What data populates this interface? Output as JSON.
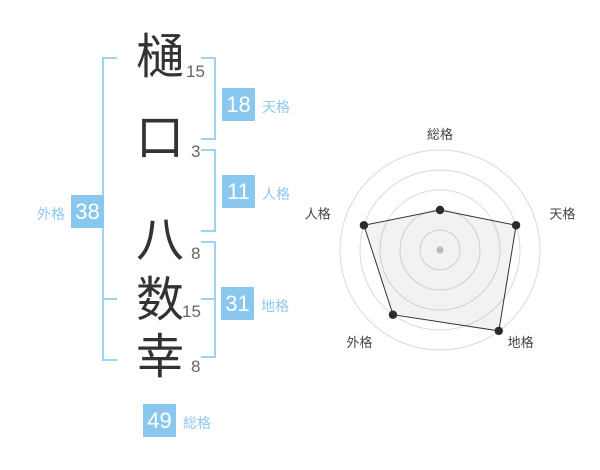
{
  "name_panel": {
    "chars": [
      {
        "char": "樋",
        "strokes": "15"
      },
      {
        "char": "口",
        "strokes": "3"
      },
      {
        "char": "八",
        "strokes": "8"
      },
      {
        "char": "数",
        "strokes": "15"
      },
      {
        "char": "幸",
        "strokes": "8"
      }
    ]
  },
  "kaku": {
    "tenkaku": {
      "label": "天格",
      "value": "18"
    },
    "jinkaku": {
      "label": "人格",
      "value": "11"
    },
    "chikaku": {
      "label": "地格",
      "value": "31"
    },
    "gaikaku": {
      "label": "外格",
      "value": "38"
    },
    "soukaku": {
      "label": "総格",
      "value": "49"
    }
  },
  "colors": {
    "accent_blue": "#89C7EE",
    "bracket_blue": "#9ED3F4",
    "badge_text": "#FFFFFF",
    "char_color": "#333333",
    "stroke_count_color": "#666666",
    "radar_ring": "#DADADA",
    "radar_polygon_line": "#333333",
    "radar_vertex_dot": "#2B2B2B",
    "radar_center_dot": "#C5C5C5",
    "radar_label_color": "#444444"
  },
  "chart_data": {
    "type": "radar",
    "axes": [
      "総格",
      "天格",
      "地格",
      "外格",
      "人格"
    ],
    "scores": [
      2,
      4,
      5,
      4,
      4
    ],
    "max": 5,
    "rings": 5,
    "kaku_values": {
      "総格": 49,
      "天格": 18,
      "地格": 31,
      "外格": 38,
      "人格": 11
    },
    "grid": "circular",
    "legend": "none"
  }
}
